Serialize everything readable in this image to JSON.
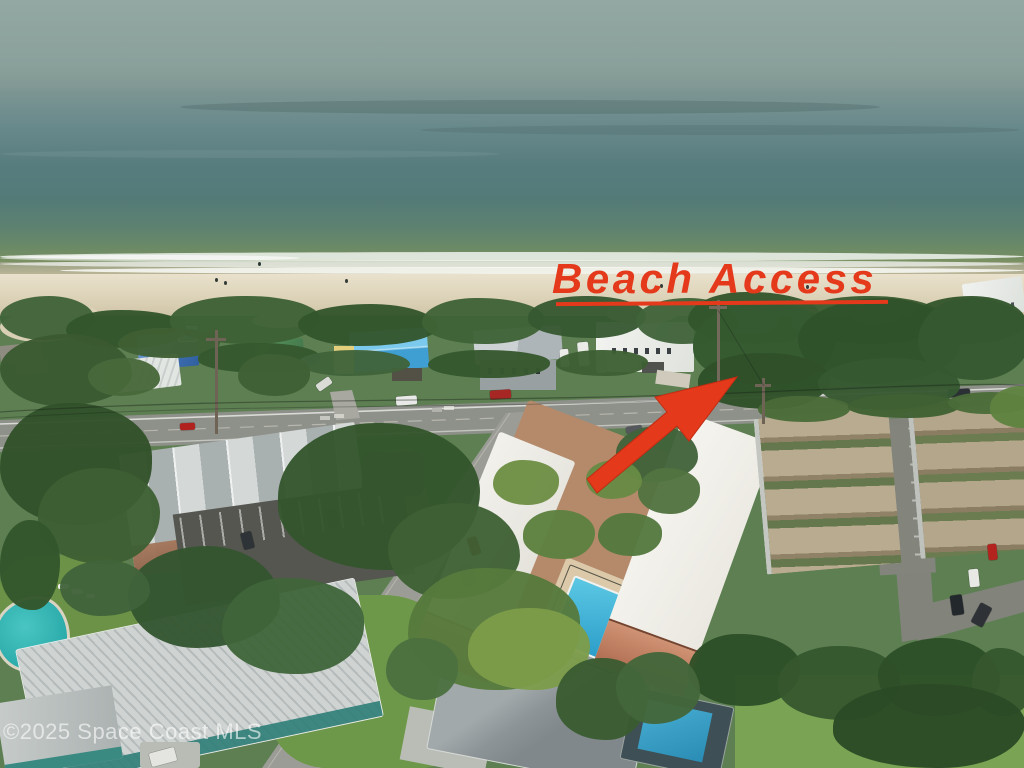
{
  "photo": {
    "annotations": {
      "beach_access_label": "Beach Access",
      "watermark": "©2025 Space Coast MLS"
    },
    "colors": {
      "annotation_red": "#e5391c",
      "sky": "#8ea49f",
      "ocean_deep": "#577c7e",
      "ocean_shallow": "#6b8a66",
      "surf_foam": "#f4f6f1",
      "sand": "#ddd3b9",
      "vegetation": "#3a5c31",
      "road_asphalt": "#8e908a",
      "white_roof": "#f2f1ec",
      "tan_roof": "#b4a68a",
      "pool_water": "#3fb7dc",
      "metal_roof": "#c3c9c8",
      "brick_wall": "#9a6b4f"
    }
  }
}
